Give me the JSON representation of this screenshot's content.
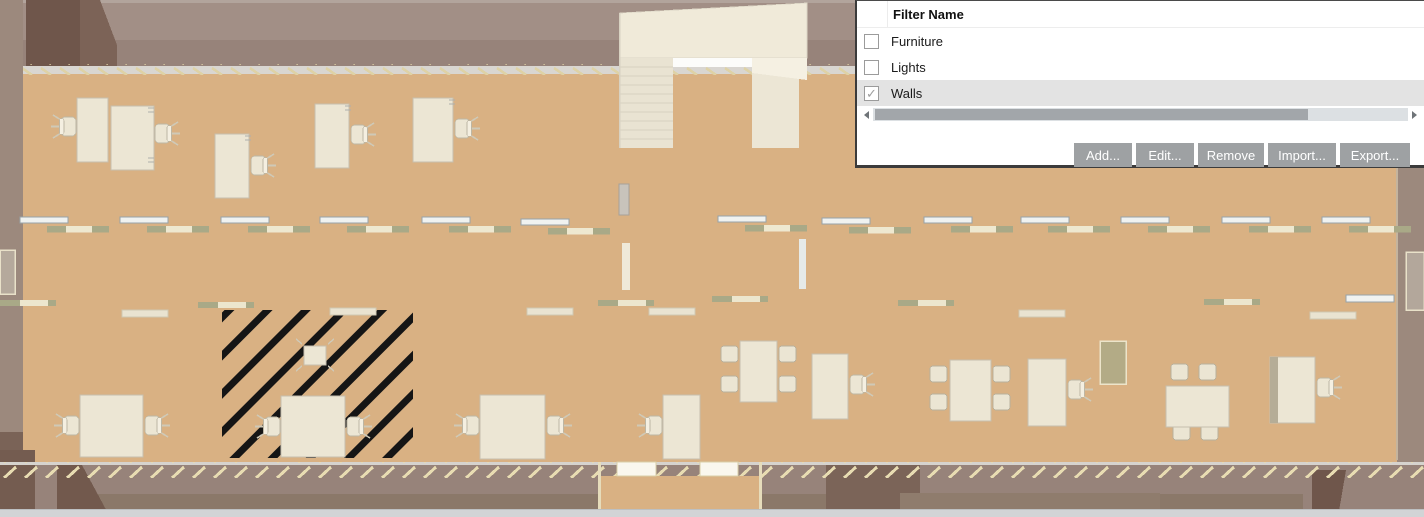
{
  "palette": {
    "floor": "#d9b183",
    "wall_upper": "#a28f86",
    "wall_lower": "#97837a",
    "wall_dark_corner": "#6f564b",
    "window_strip": "#d9d6d1",
    "furniture": "#ece6d4",
    "hatch_stripe": "#151515",
    "dialog_selected_row": "#e3e3e3",
    "dialog_button": "#9ea1a3",
    "scrollbar_thumb": "#a2a6aa"
  },
  "dialog": {
    "header": "Filter Name",
    "rows": [
      {
        "label": "Furniture",
        "checked": false,
        "selected": false
      },
      {
        "label": "Lights",
        "checked": false,
        "selected": false
      },
      {
        "label": "Walls",
        "checked": true,
        "selected": true
      }
    ],
    "check_glyph": "✓",
    "scrollbar": {
      "orientation": "horizontal",
      "thumb_fraction": 0.81
    },
    "buttons": [
      {
        "label": "Add..."
      },
      {
        "label": "Edit..."
      },
      {
        "label": "Remove"
      },
      {
        "label": "Import..."
      },
      {
        "label": "Export..."
      }
    ]
  }
}
